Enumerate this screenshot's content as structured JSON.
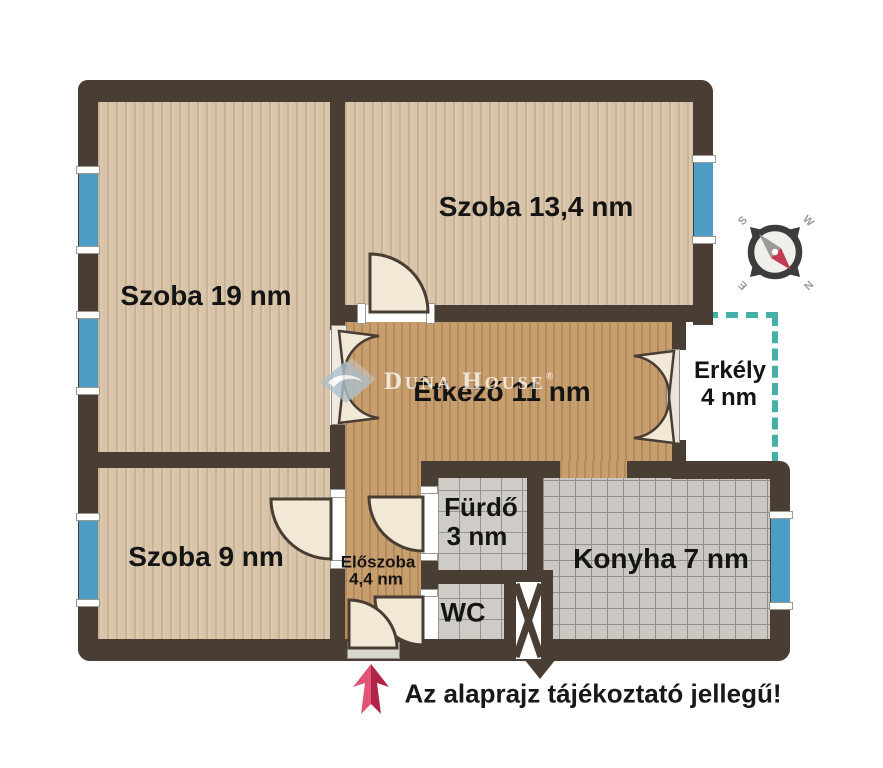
{
  "rooms": {
    "szoba19": "Szoba 19 nm",
    "szoba134": "Szoba 13,4 nm",
    "etkezo": "Étkező 11 nm",
    "erkely1": "Erkély",
    "erkely2": "4 nm",
    "szoba9": "Szoba 9 nm",
    "eloszoba1": "Előszoba",
    "eloszoba2": "4,4 nm",
    "furdo1": "Fürdő",
    "furdo2": "3 nm",
    "wc": "WC",
    "konyha": "Konyha 7 nm"
  },
  "compass": {
    "n": "N",
    "s": "S",
    "e": "E",
    "w": "W"
  },
  "watermark": {
    "brand": "Duna House",
    "registered": "®"
  },
  "caption": "Az alaprajz tájékoztató jellegű!",
  "colors": {
    "wall": "#4a3e34",
    "window_blue": "#4e9dc6",
    "balcony_dash_teal": "#45b0a6",
    "arrow_red": "#c9274e",
    "floor_light_wood": "#d8c4a8",
    "floor_warm_wood": "#c79e6e",
    "tile_gray": "#cbc8c3",
    "door_cream": "#f1e8d5"
  }
}
